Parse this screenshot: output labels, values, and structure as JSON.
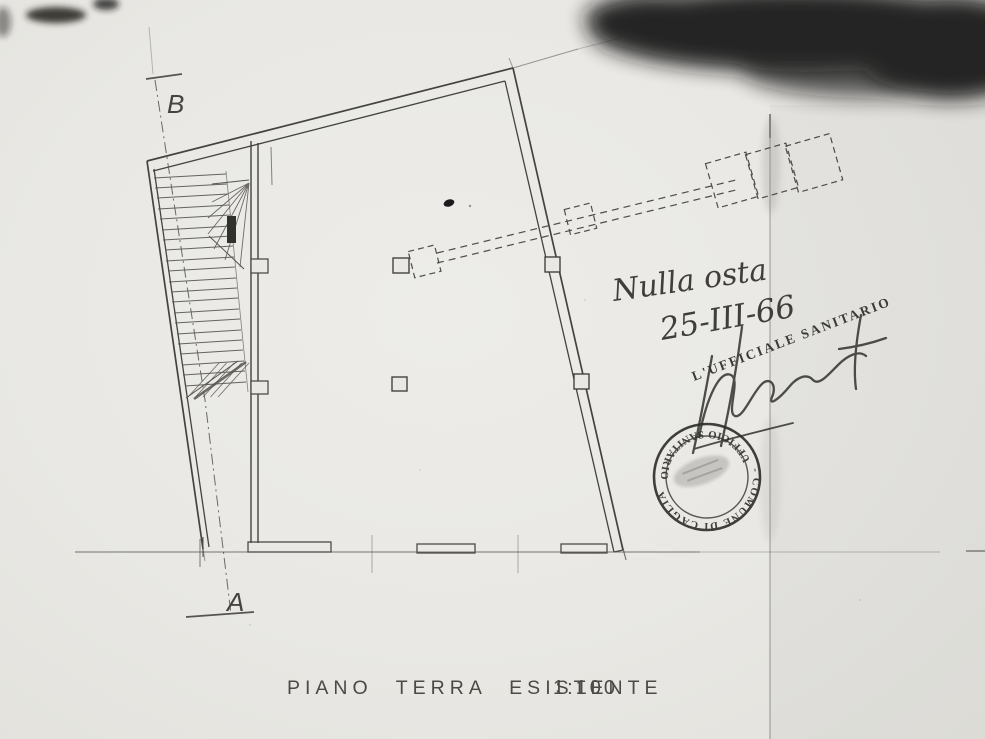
{
  "document": {
    "kind": "scanned architectural floor plan",
    "paper_color": "#e9e8e4",
    "ink_color": "#45443f",
    "pencil_color": "#6f6e69",
    "stamp_color": "#2c2c29"
  },
  "caption": {
    "title": "PIANO TERRA ESISTENTE",
    "scale": "1:100"
  },
  "section_markers": {
    "top_label": "B",
    "bottom_label": "A"
  },
  "handwritten": {
    "line1": "Nulla osta",
    "line2": "25-III-66",
    "official_role": "L'UFFICIALE SANITARIO"
  },
  "stamp": {
    "arc_top": "UFFICIO SANITARIO",
    "arc_bottom": "- COMUNE DI CAGLIARI -"
  }
}
